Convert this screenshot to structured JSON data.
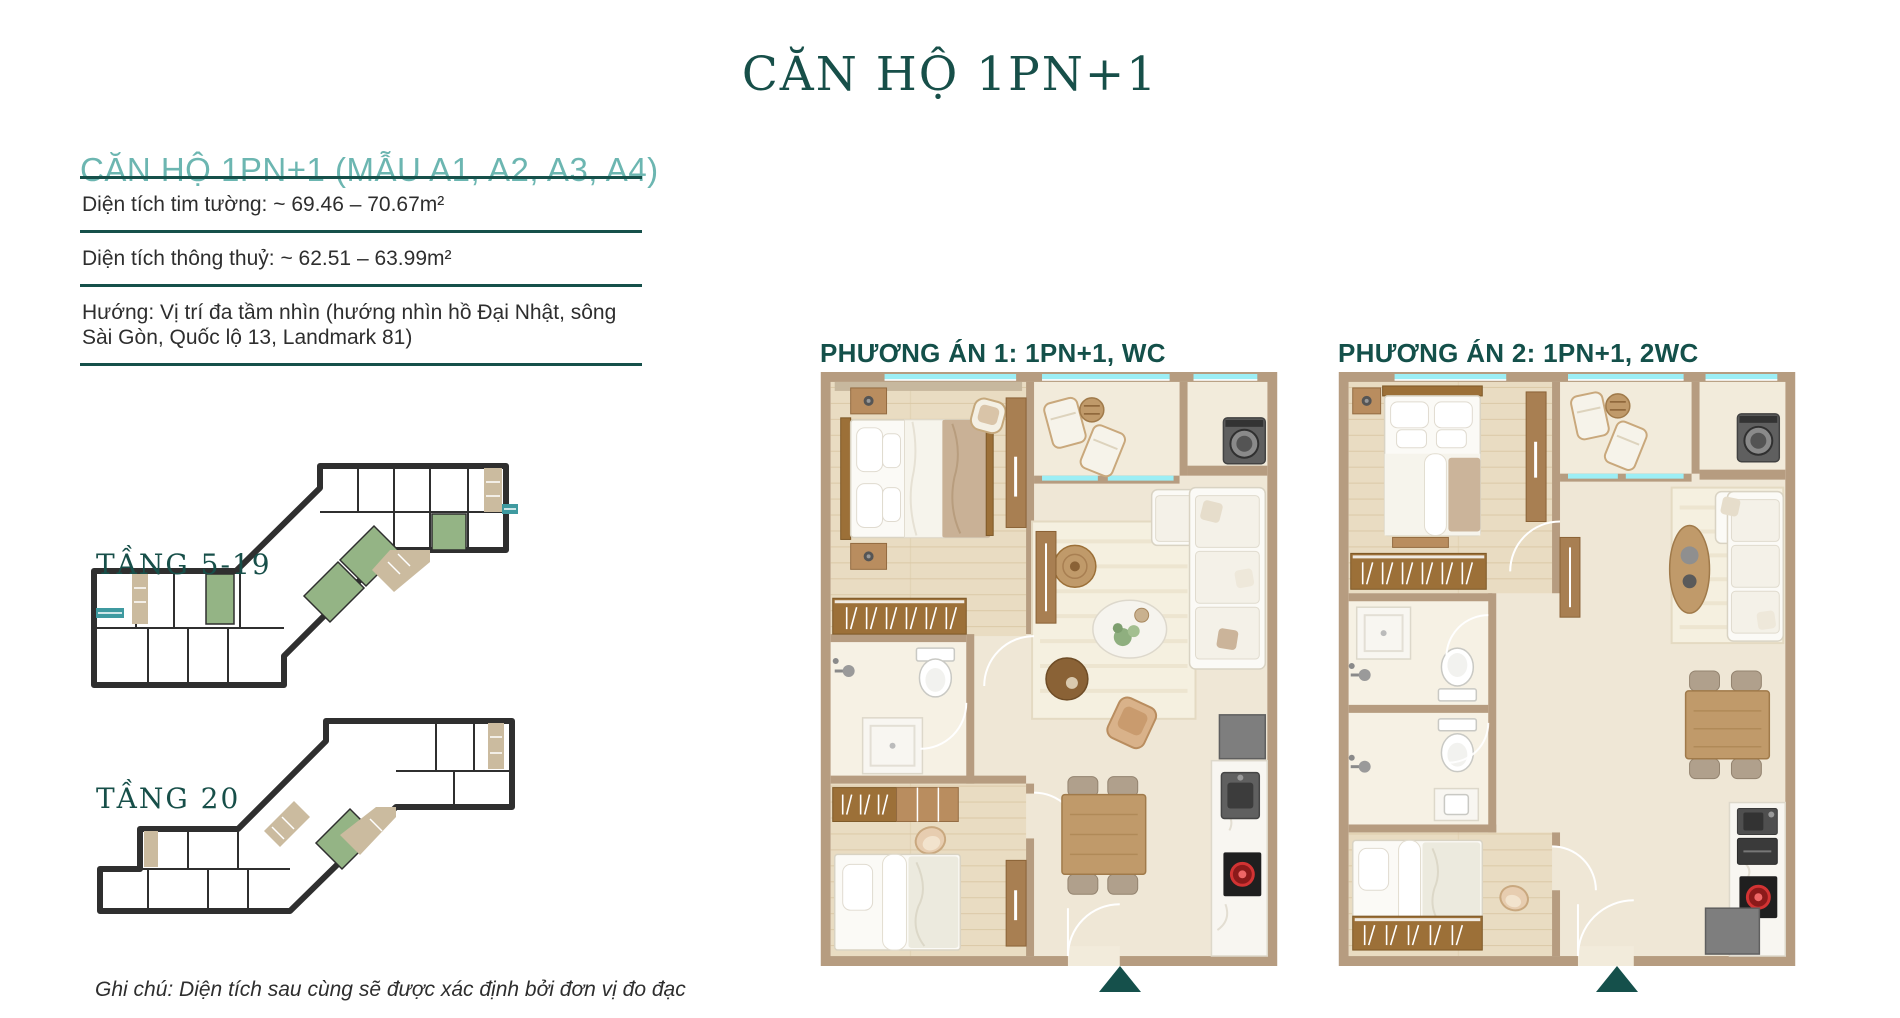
{
  "title": "CĂN HỘ 1PN+1",
  "left_panel": {
    "heading": "CĂN HỘ 1PN+1 (MẪU A1, A2, A3, A4)",
    "specs": [
      {
        "text": "Diện tích tim tường: ~ 69.46 – 70.67m²"
      },
      {
        "text": "Diện tích thông thuỷ: ~ 62.51 – 63.99m²"
      },
      {
        "text": "Hướng: Vị trí đa tầm nhìn (hướng nhìn hồ Đại Nhật, sông Sài Gòn, Quốc lộ 13, Landmark 81)"
      }
    ],
    "floors": [
      {
        "label": "TẦNG 5-19"
      },
      {
        "label": "TẦNG 20"
      }
    ],
    "note": "Ghi chú: Diện tích sau cùng sẽ được xác định bởi đơn vị đo đạc"
  },
  "plans": [
    {
      "label": "PHƯƠNG ÁN 1: 1PN+1, WC"
    },
    {
      "label": "PHƯƠNG ÁN 2: 1PN+1, 2WC"
    }
  ],
  "colors": {
    "accent_dark_teal": "#16504A",
    "heading_teal": "#6CB6B1",
    "wall_tan": "#B69C80",
    "floor_cream": "#EFE7D5",
    "wood_floor": "#E9DCC2",
    "unit_green": "#94B485",
    "core_beige": "#CBBB9F",
    "glass_cyan": "#9CEEF5",
    "text_dark": "#2B2B2B"
  }
}
